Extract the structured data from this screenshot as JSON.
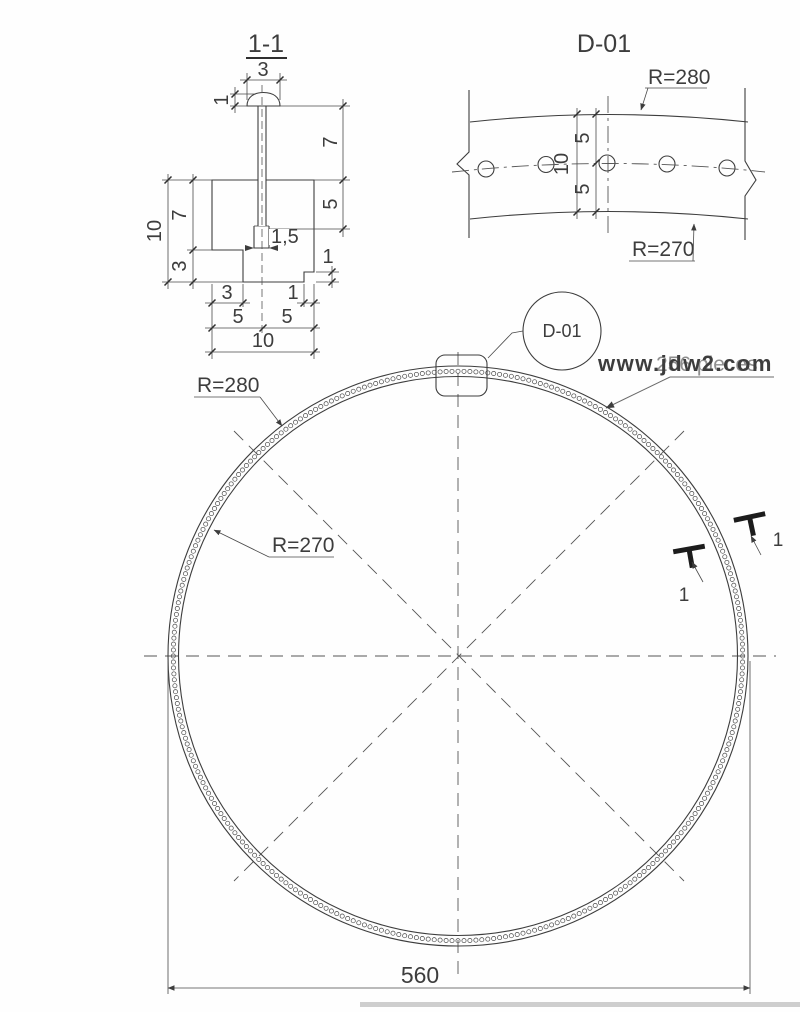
{
  "section_view": {
    "title": "1-1",
    "dims": {
      "head_width": "3",
      "head_height": "1",
      "shank_exposed": "7",
      "shank_embedded": "5",
      "slot_width": "1,5",
      "height_total": "10",
      "height_upper": "7",
      "height_lower": "3",
      "bottom_notch": "3",
      "bottom_step": "1",
      "bottom_left": "5",
      "bottom_right": "5",
      "bottom_total": "10",
      "side_step": "1"
    }
  },
  "detail_view": {
    "title": "D-01",
    "outer_radius_label": "R=280",
    "inner_radius_label": "R=270",
    "dims": {
      "upper_half": "5",
      "lower_half": "5",
      "total": "10"
    }
  },
  "plan_view": {
    "outer_radius_label": "R=280",
    "inner_radius_label": "R=270",
    "diameter": "560",
    "callout_label": "D-01",
    "pieces_note": "256 pieces",
    "rivet_mark_left": "1",
    "rivet_mark_right": "1"
  },
  "watermark": {
    "text": "www.jdw2.com",
    "color": "#e8470e"
  }
}
